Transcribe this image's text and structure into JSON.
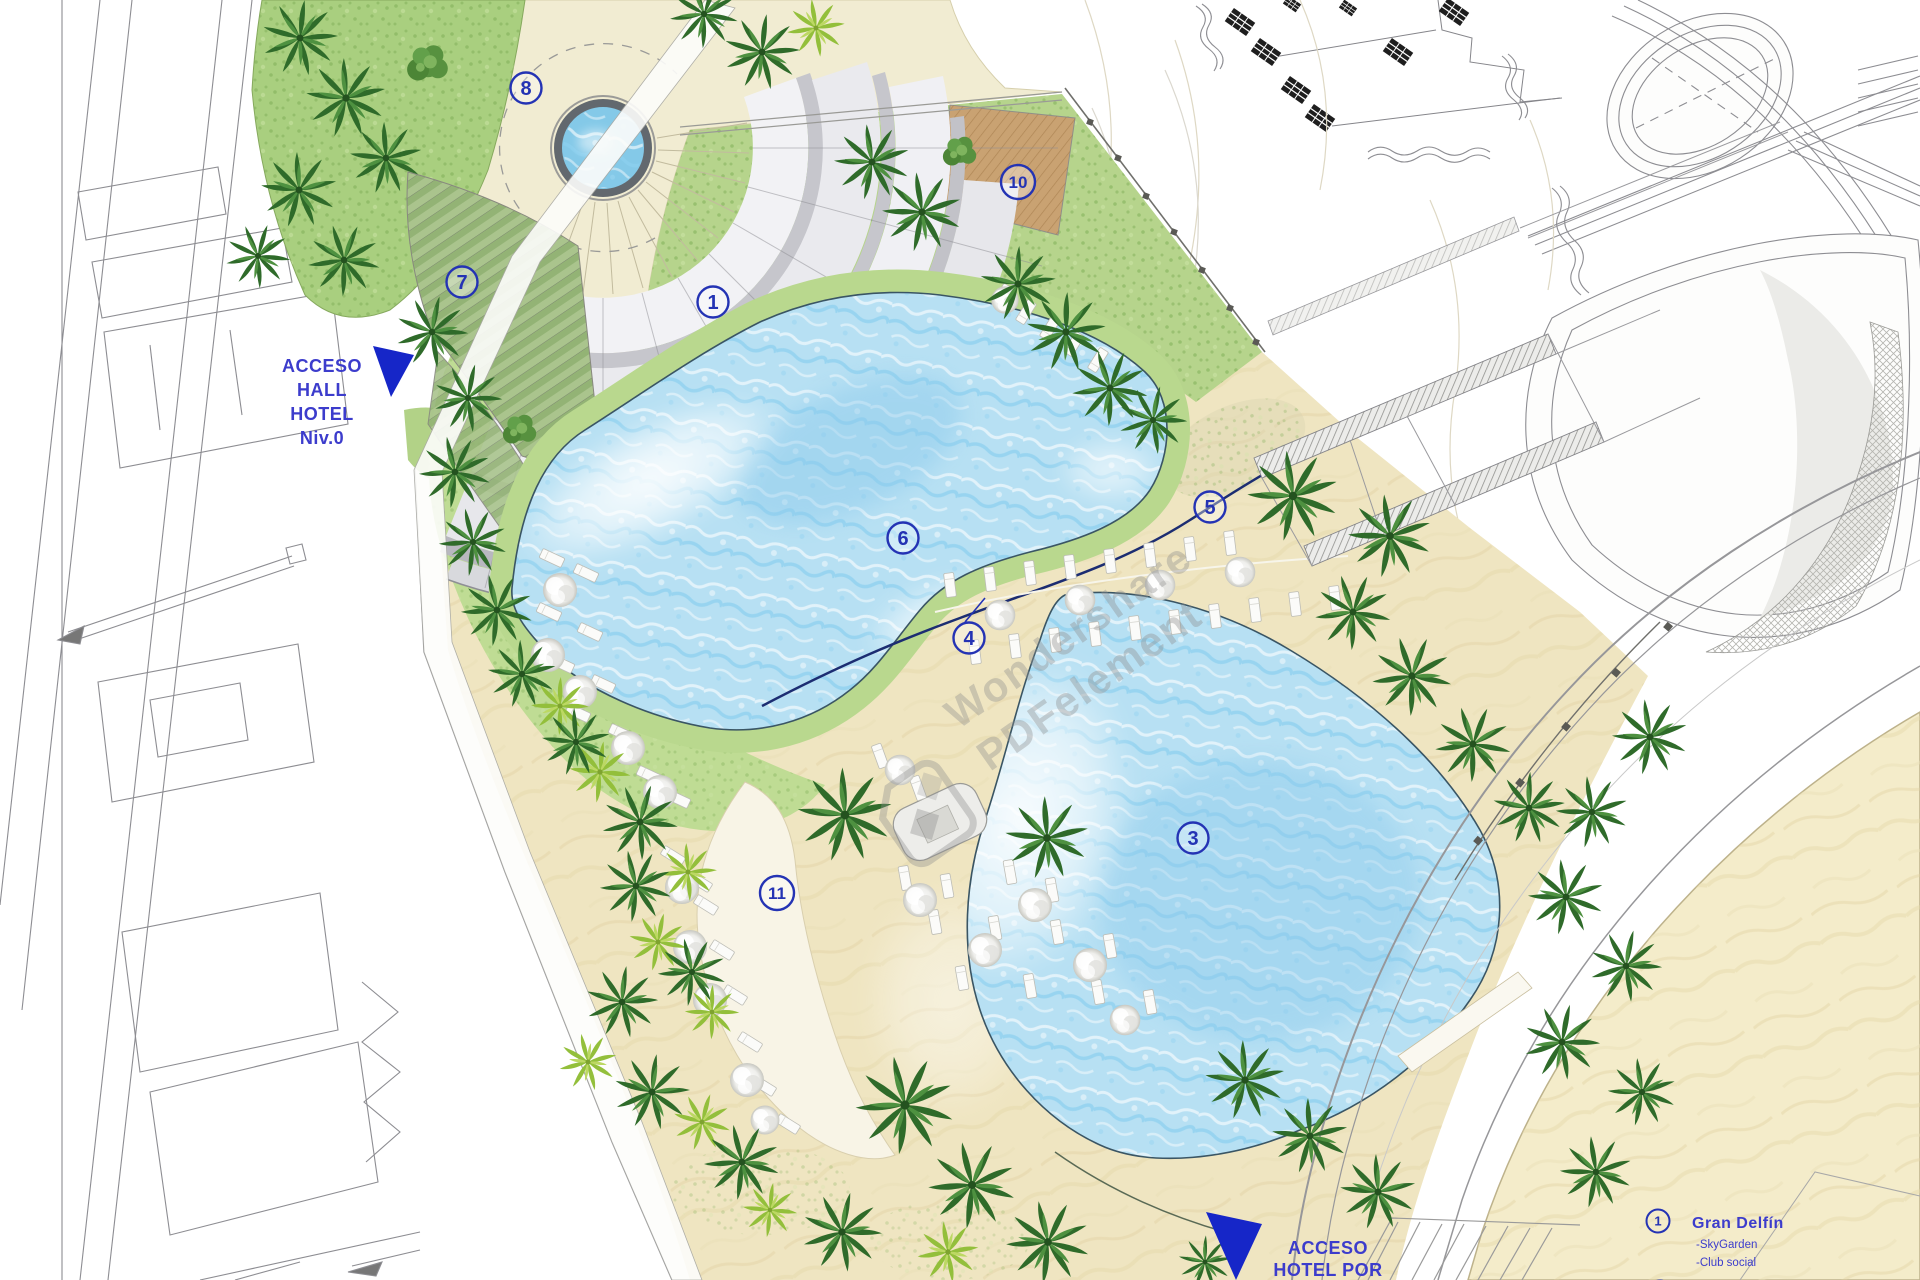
{
  "plan": {
    "labels": {
      "access_hall": [
        "ACCESO",
        "HALL",
        "HOTEL",
        "Niv.0"
      ],
      "access_hotel": [
        "ACCESO",
        "HOTEL POR"
      ]
    },
    "markers": [
      {
        "id": "m1",
        "label": "1"
      },
      {
        "id": "m3",
        "label": "3"
      },
      {
        "id": "m4",
        "label": "4"
      },
      {
        "id": "m5",
        "label": "5"
      },
      {
        "id": "m6",
        "label": "6"
      },
      {
        "id": "m7",
        "label": "7"
      },
      {
        "id": "m8",
        "label": "8"
      },
      {
        "id": "m10",
        "label": "10"
      },
      {
        "id": "m11",
        "label": "11"
      }
    ],
    "legend": {
      "items": [
        {
          "num": "1",
          "title": "Gran Delfín",
          "details": [
            "-SkyGarden",
            "-Club social"
          ]
        }
      ]
    },
    "watermark": {
      "line1": "Wondershare",
      "line2": "PDFelement"
    },
    "colors": {
      "water": "#aeddf2",
      "sand": "#efe5c1",
      "lawn": "#b6d48c",
      "deck_green": "#bfdc94",
      "plaza": "#f1ecd2",
      "marker_blue": "#2433b4",
      "label_blue": "#3c3ccc",
      "wood_deck": "#c9a272"
    }
  }
}
